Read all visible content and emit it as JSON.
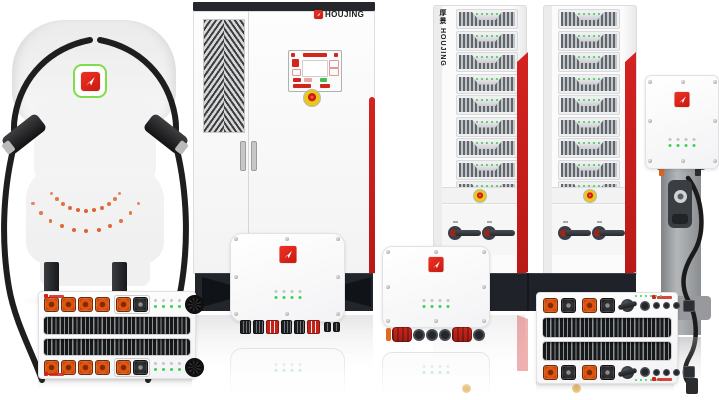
{
  "brand": {
    "name": "HOUJING",
    "vertical_name": "厚景 HOUJING",
    "logo_icon": "cursor-arrow-icon",
    "logo_red": "#d2241b",
    "logo_green_ring": "#7fdc4a"
  },
  "colors": {
    "accent_red_stripe": "#ce1d1a",
    "connector_orange": "#e2540e",
    "led_green": "#3ecf57",
    "estop_yellow": "#e8c81c",
    "estop_red": "#cf1f14",
    "cabinet_dark_base": "#22262b",
    "cable_black": "#1e1e1e",
    "body_gray": "#f3f3f4",
    "pedestal_gray": "#9a9da0"
  },
  "racks": {
    "count": 2,
    "modules_per_rack": 9,
    "leds_per_module": 5,
    "switches_per_rack": 2
  },
  "station": {
    "dot_arc_count": 2,
    "dots_per_arc": 11,
    "arc_radii": [
      62,
      40
    ],
    "cable_count": 2
  },
  "icons": {
    "logo": "cursor-arrow-icon",
    "estop": "emergency-stop-button",
    "fan": "fan-icon",
    "plug": "power-connector",
    "switch": "rotary-breaker-switch"
  }
}
